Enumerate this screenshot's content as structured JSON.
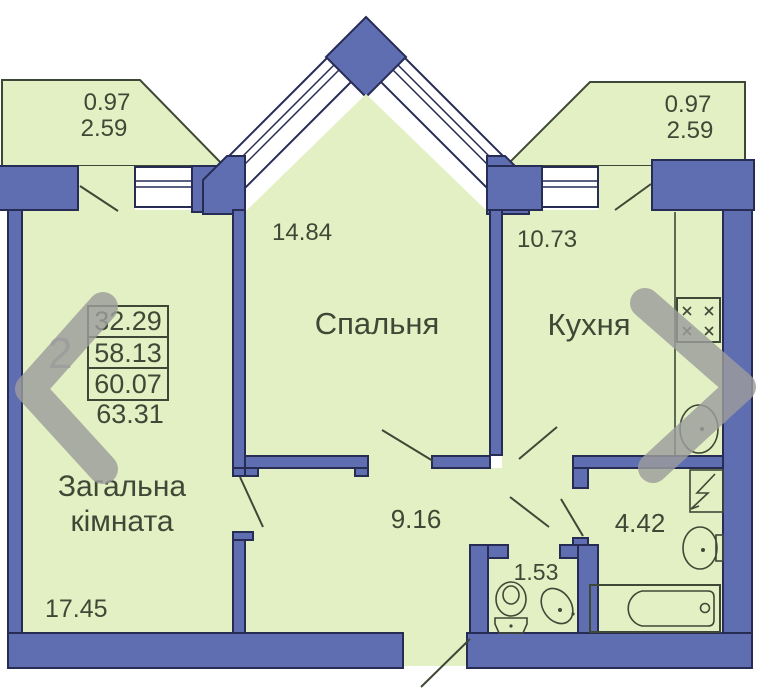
{
  "colors": {
    "wall": "#5e6eb1",
    "wallOutline": "#272c55",
    "room": "#e2f0c3",
    "line": "#3e4836",
    "text": "#3e4836",
    "overlay": "#9c9c9c",
    "bg": "#ffffff"
  },
  "labels": {
    "bedroom": {
      "name": "Спальня",
      "area": "14.84"
    },
    "kitchen": {
      "name": "Кухня",
      "area": "10.73"
    },
    "living": {
      "name_line1": "Загальна",
      "name_line2": "кімната",
      "area": "17.45"
    },
    "hallway": {
      "area": "9.16"
    },
    "bathroom": {
      "area": "4.42"
    },
    "wc": {
      "area": "1.53"
    },
    "balcony_left": {
      "depth": "0.97",
      "length": "2.59"
    },
    "balcony_right": {
      "depth": "0.97",
      "length": "2.59"
    }
  },
  "area_table": {
    "rows": [
      "32.29",
      "58.13",
      "60.07"
    ],
    "total": "63.31"
  },
  "overlay": {
    "photo_counter": "2"
  }
}
